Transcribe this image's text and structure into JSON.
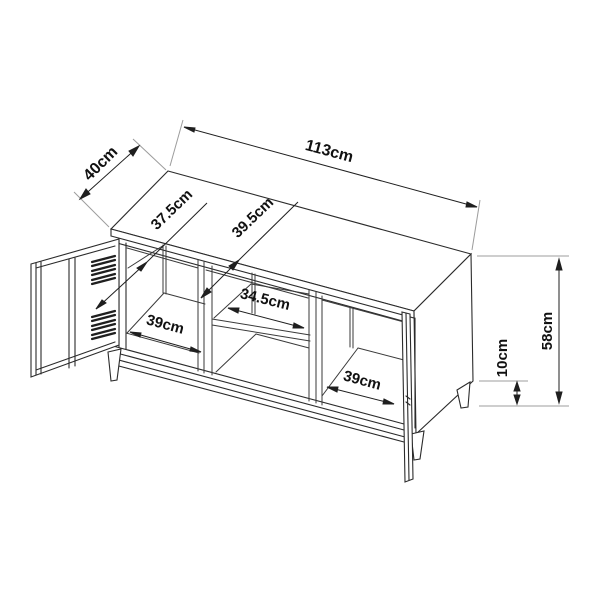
{
  "labels": {
    "overall_width": "113cm",
    "depth": "40cm",
    "door_width": "37.5cm",
    "inner_height": "39.5cm",
    "shelf_width": "34.5cm",
    "left_compartment_width": "39cm",
    "right_compartment_width": "39cm",
    "leg_height": "10cm",
    "overall_height": "58cm"
  },
  "colors": {
    "background": "#ffffff",
    "outline": "#2b2b2b",
    "interior_line": "#3a3a3a",
    "extension_line": "#9c9c9c",
    "dimension_line": "#1f1f1f",
    "text": "#111111"
  }
}
